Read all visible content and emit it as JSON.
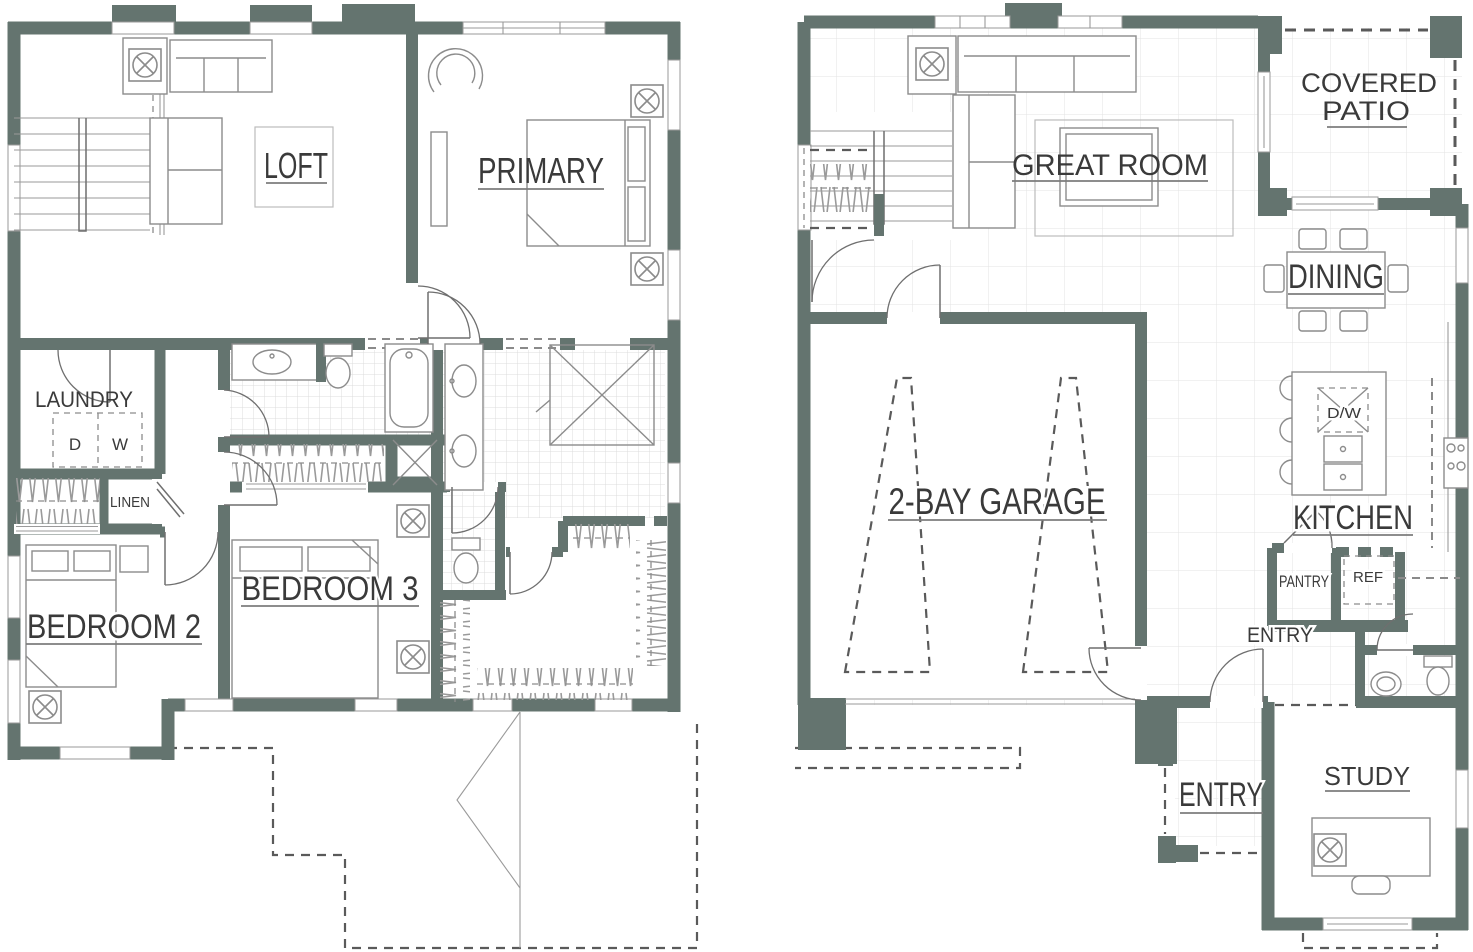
{
  "document": {
    "type": "floor-plan",
    "description": "Two-story residential floor plan, two plans side by side"
  },
  "plans": {
    "second_floor": {
      "rooms": {
        "loft": "LOFT",
        "primary": "PRIMARY",
        "laundry": "LAUNDRY",
        "dryer": "D",
        "washer": "W",
        "linen": "LINEN",
        "bedroom2": "BEDROOM 2",
        "bedroom3": "BEDROOM 3"
      }
    },
    "first_floor": {
      "rooms": {
        "great_room": "GREAT ROOM",
        "covered_patio_line1": "COVERED",
        "covered_patio_line2": "PATIO",
        "dining": "DINING",
        "garage": "2-BAY GARAGE",
        "kitchen": "KITCHEN",
        "dishwasher": "D/W",
        "pantry": "PANTRY",
        "refrigerator": "REF",
        "entry_hall": "ENTRY",
        "entry_porch": "ENTRY",
        "study": "STUDY"
      }
    }
  },
  "colors": {
    "wall": "#64746f",
    "line": "#9a9a9a",
    "line_dark": "#6f6f6f",
    "furniture": "#8c8c8c",
    "text": "#3a3a3a",
    "underline": "#7d7d7d",
    "dash": "#5a5a5a",
    "grid": "#e3e3e3",
    "grid_bath": "#dcdcdc",
    "background": "#ffffff"
  }
}
